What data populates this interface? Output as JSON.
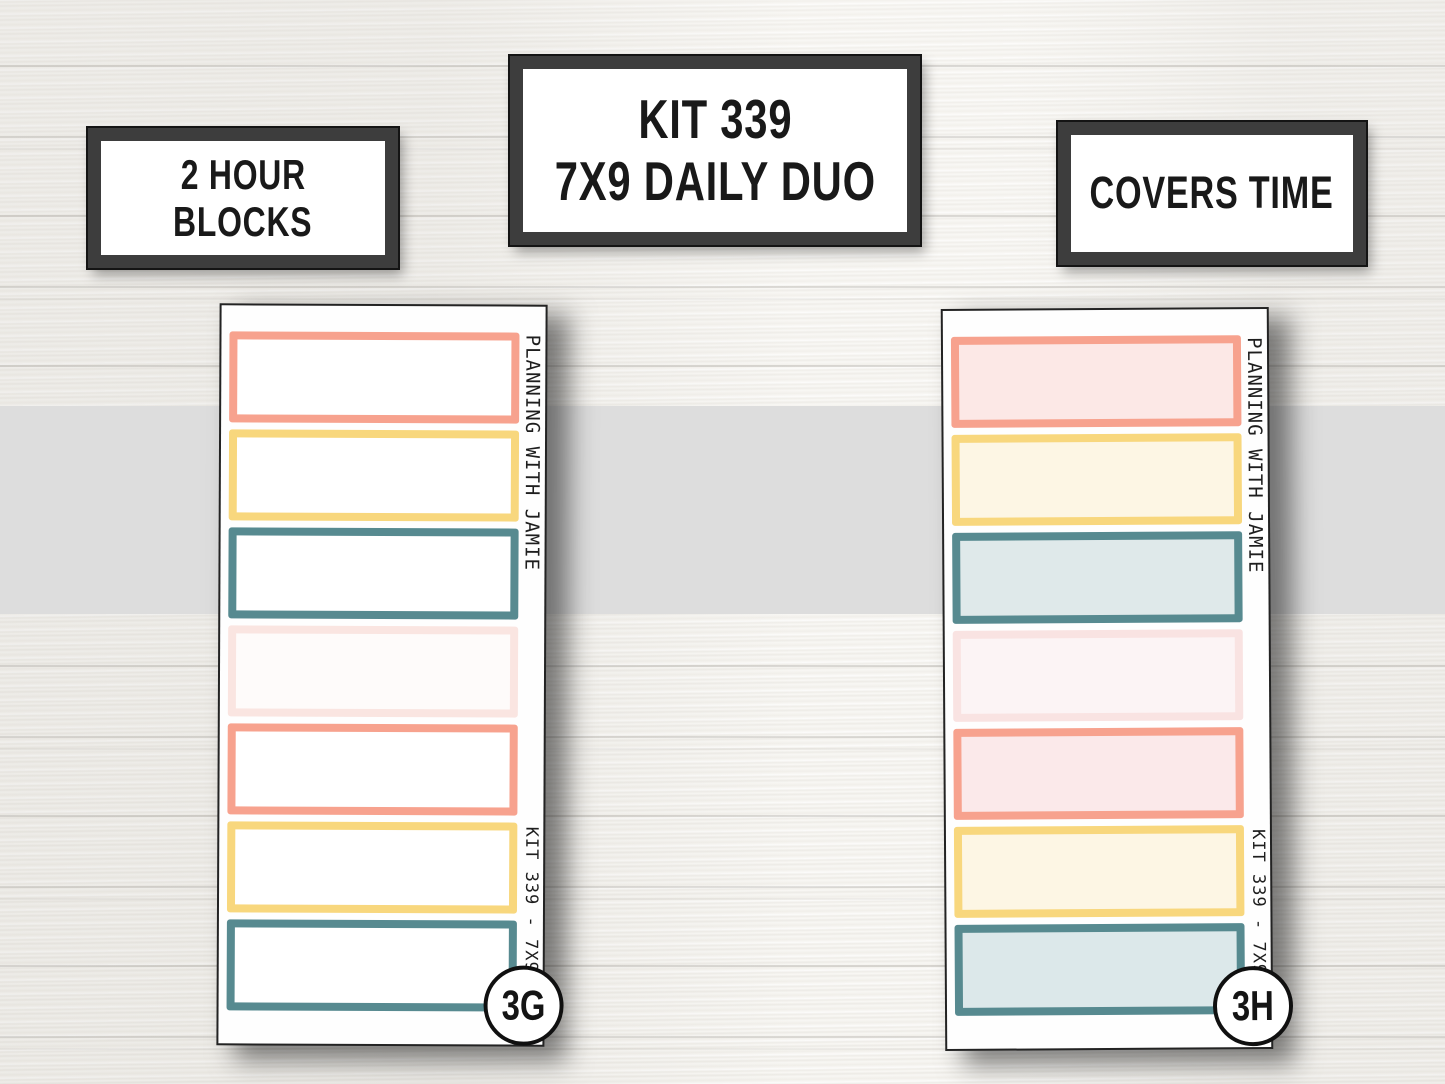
{
  "header_labels": {
    "hour_blocks": {
      "line1": "2 HOUR",
      "line2": "BLOCKS"
    },
    "kit_title": {
      "line1": "KIT 339",
      "line2": "7X9 DAILY DUO"
    },
    "covers_time": {
      "text": "COVERS TIME"
    }
  },
  "sheets": {
    "left": {
      "brand_text": "PLANNING WITH JAMIE",
      "kit_text": "KIT 339 - 7X9 DD",
      "badge": "3G",
      "boxes": [
        {
          "name": "salmon",
          "border": "#f7a28e",
          "fill": "#ffffff"
        },
        {
          "name": "yellow",
          "border": "#f8d77d",
          "fill": "#ffffff"
        },
        {
          "name": "teal",
          "border": "#578a90",
          "fill": "#ffffff"
        },
        {
          "name": "pale-pink",
          "border": "#fae5e1",
          "fill": "#fefbfa"
        },
        {
          "name": "salmon",
          "border": "#f7a28e",
          "fill": "#ffffff"
        },
        {
          "name": "yellow",
          "border": "#f8d77d",
          "fill": "#ffffff"
        },
        {
          "name": "teal",
          "border": "#578a90",
          "fill": "#ffffff"
        }
      ]
    },
    "right": {
      "brand_text": "PLANNING WITH JAMIE",
      "kit_text": "KIT 339 - 7X9 DD",
      "badge": "3H",
      "boxes": [
        {
          "name": "salmon",
          "border": "#f7a28e",
          "fill": "#fce8e6"
        },
        {
          "name": "yellow",
          "border": "#f8d77d",
          "fill": "#fdf6e4"
        },
        {
          "name": "teal",
          "border": "#578a90",
          "fill": "#dfe9ea"
        },
        {
          "name": "pale-pink",
          "border": "#f9e3e2",
          "fill": "#fcf4f5"
        },
        {
          "name": "salmon",
          "border": "#f7a28e",
          "fill": "#fbe9ea"
        },
        {
          "name": "yellow",
          "border": "#f8d77d",
          "fill": "#fdf6e4"
        },
        {
          "name": "teal",
          "border": "#578a90",
          "fill": "#dce8ea"
        }
      ]
    }
  },
  "colors": {
    "salmon": "#f7a28e",
    "yellow": "#f8d77d",
    "teal": "#578a90",
    "pale_pink": "#fae5e1",
    "gray_band": "#dddddd",
    "frame_dark": "#3d3d3d",
    "text": "#191919",
    "sheet_white": "#fefefe"
  }
}
